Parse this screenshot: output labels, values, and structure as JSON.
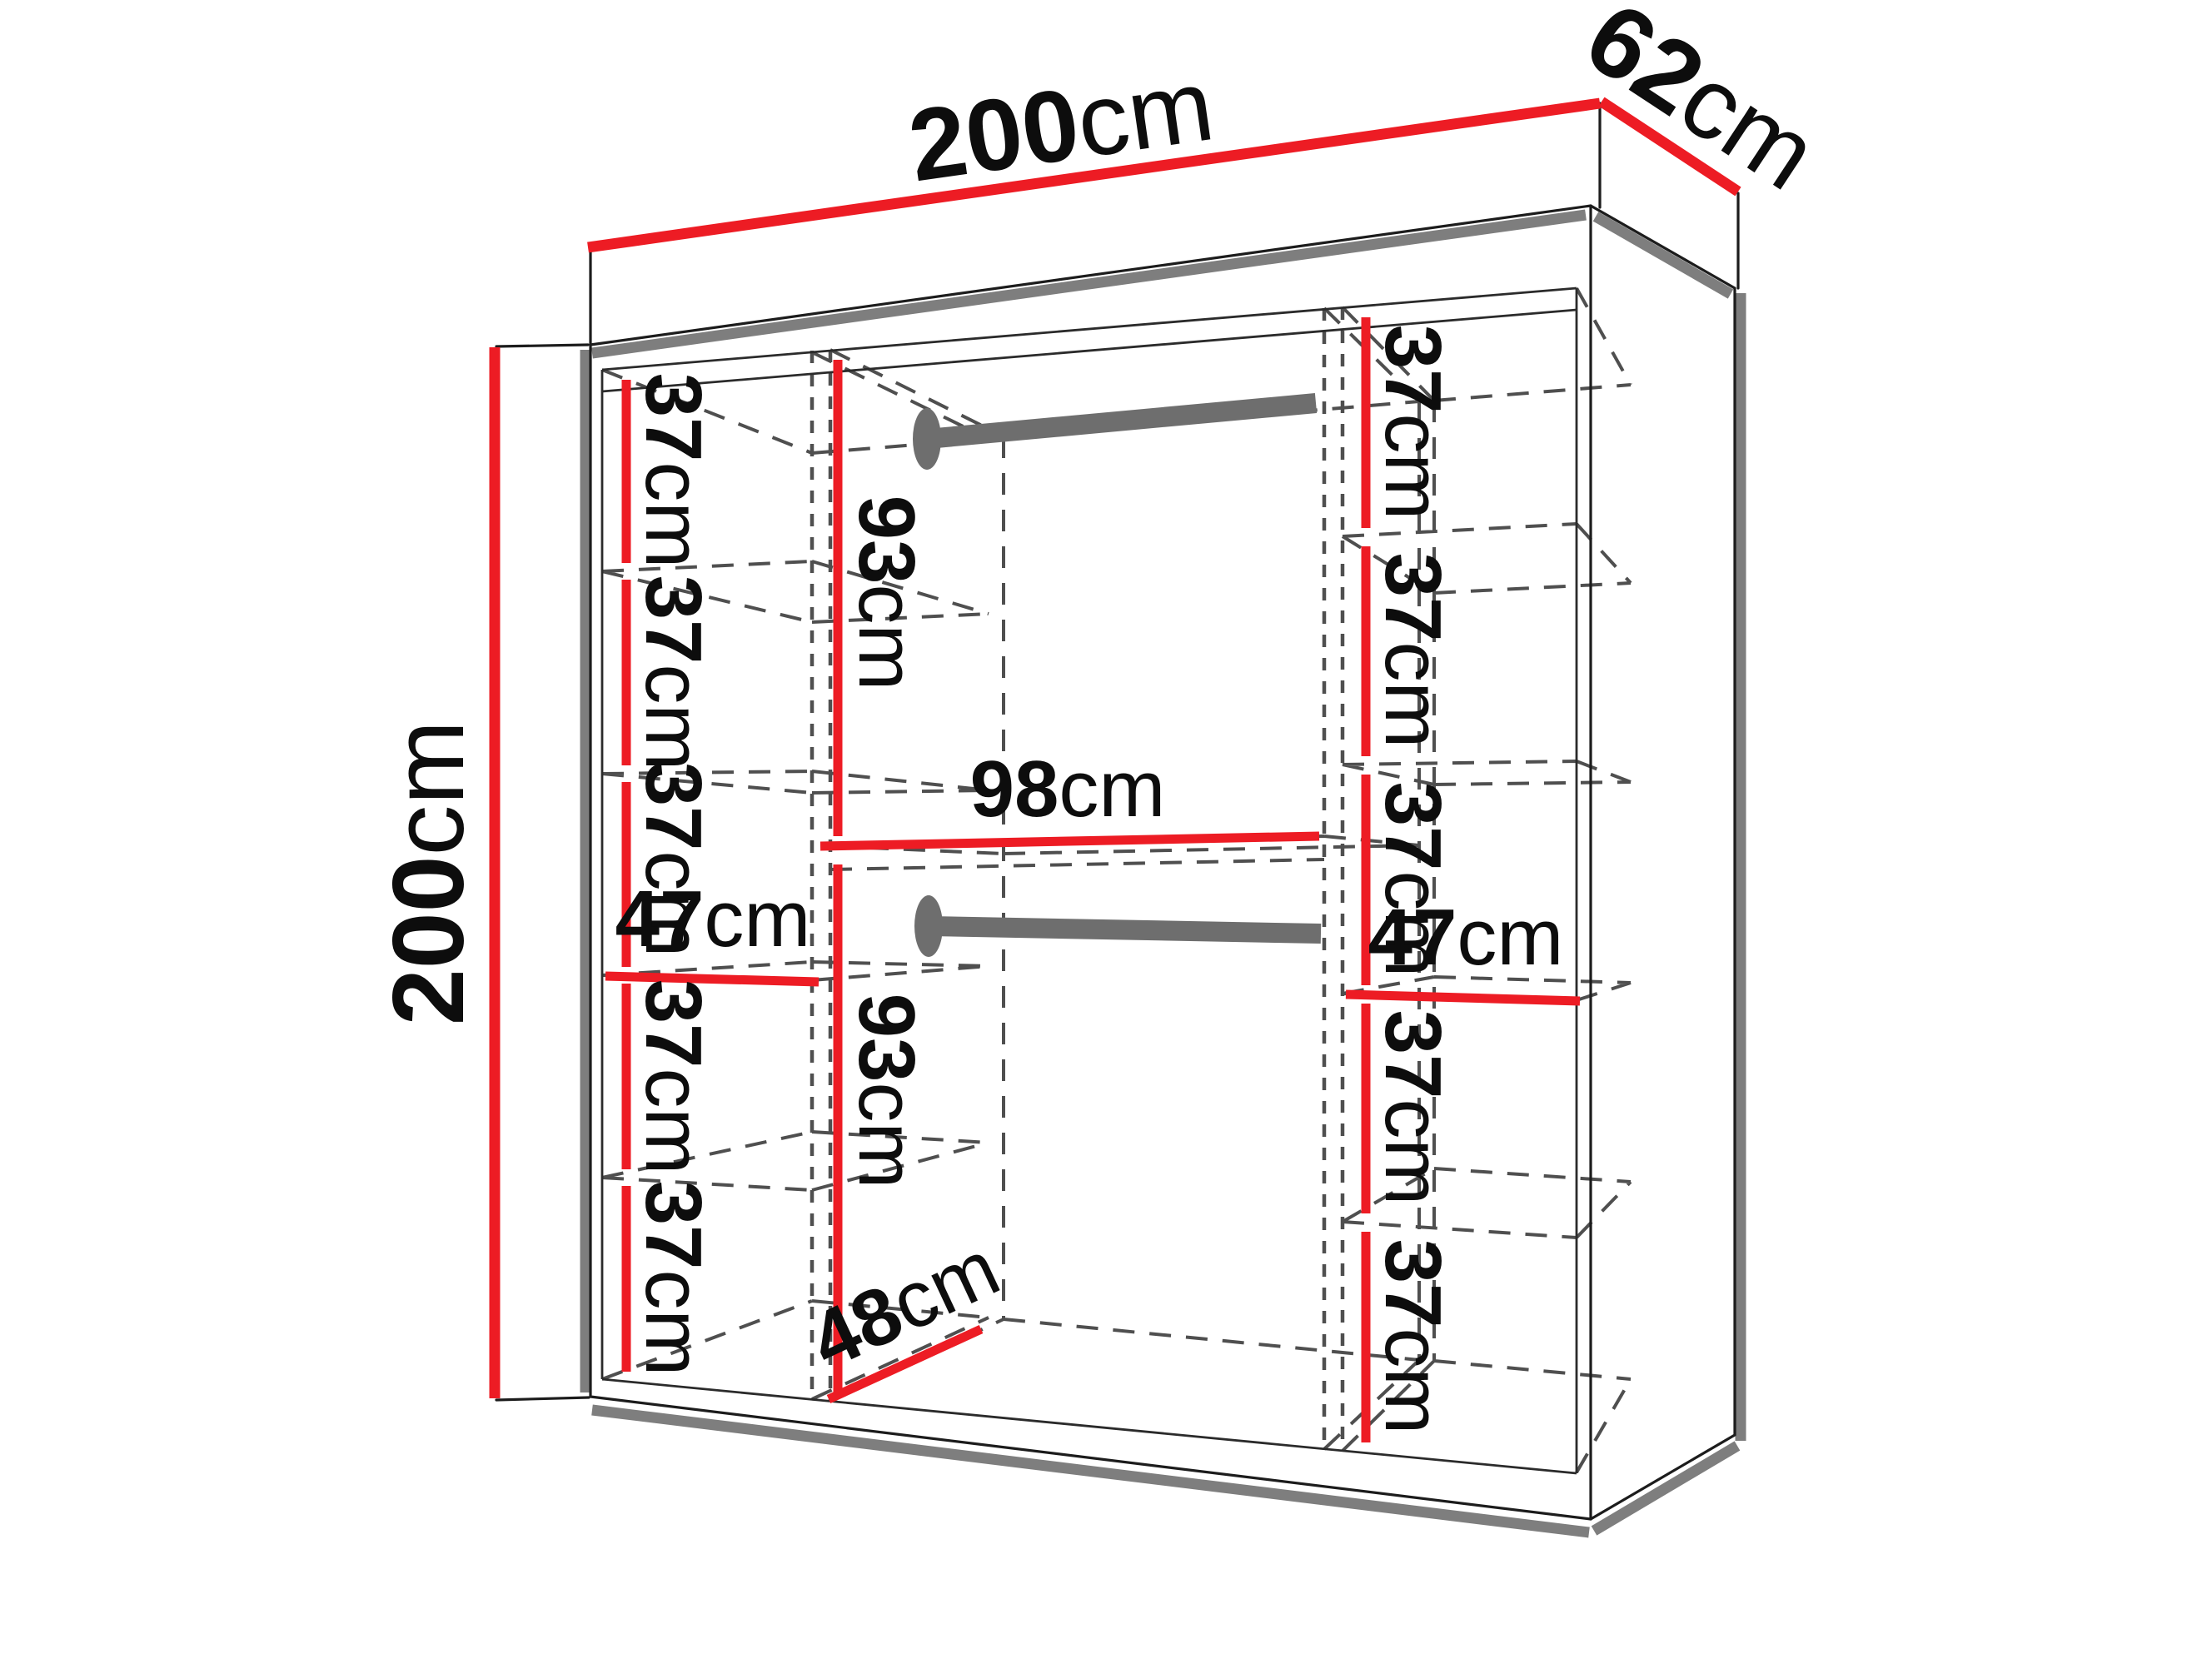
{
  "wardrobe": {
    "overall": {
      "width": {
        "num": "200",
        "unit": "cm"
      },
      "depth": {
        "num": "62",
        "unit": "cm"
      },
      "height": {
        "num": "200",
        "unit": "cm"
      }
    },
    "left_column": {
      "gaps": {
        "g1": {
          "num": "37",
          "unit": "cm"
        },
        "g2": {
          "num": "37",
          "unit": "cm"
        },
        "g3": {
          "num": "37",
          "unit": "cm"
        },
        "g4": {
          "num": "37",
          "unit": "cm"
        },
        "g5": {
          "num": "37",
          "unit": "cm"
        }
      },
      "width": {
        "num": "47",
        "unit": "cm"
      }
    },
    "middle_section": {
      "upper_height": {
        "num": "93",
        "unit": "cm"
      },
      "width": {
        "num": "98",
        "unit": "cm"
      },
      "lower_height": {
        "num": "93",
        "unit": "cm"
      },
      "depth": {
        "num": "48",
        "unit": "cm"
      }
    },
    "right_column": {
      "gaps": {
        "g1": {
          "num": "37",
          "unit": "cm"
        },
        "g2": {
          "num": "37",
          "unit": "cm"
        },
        "g3": {
          "num": "37",
          "unit": "cm"
        },
        "g4": {
          "num": "37",
          "unit": "cm"
        },
        "g5": {
          "num": "37",
          "unit": "cm"
        }
      },
      "width": {
        "num": "47",
        "unit": "cm"
      }
    }
  }
}
